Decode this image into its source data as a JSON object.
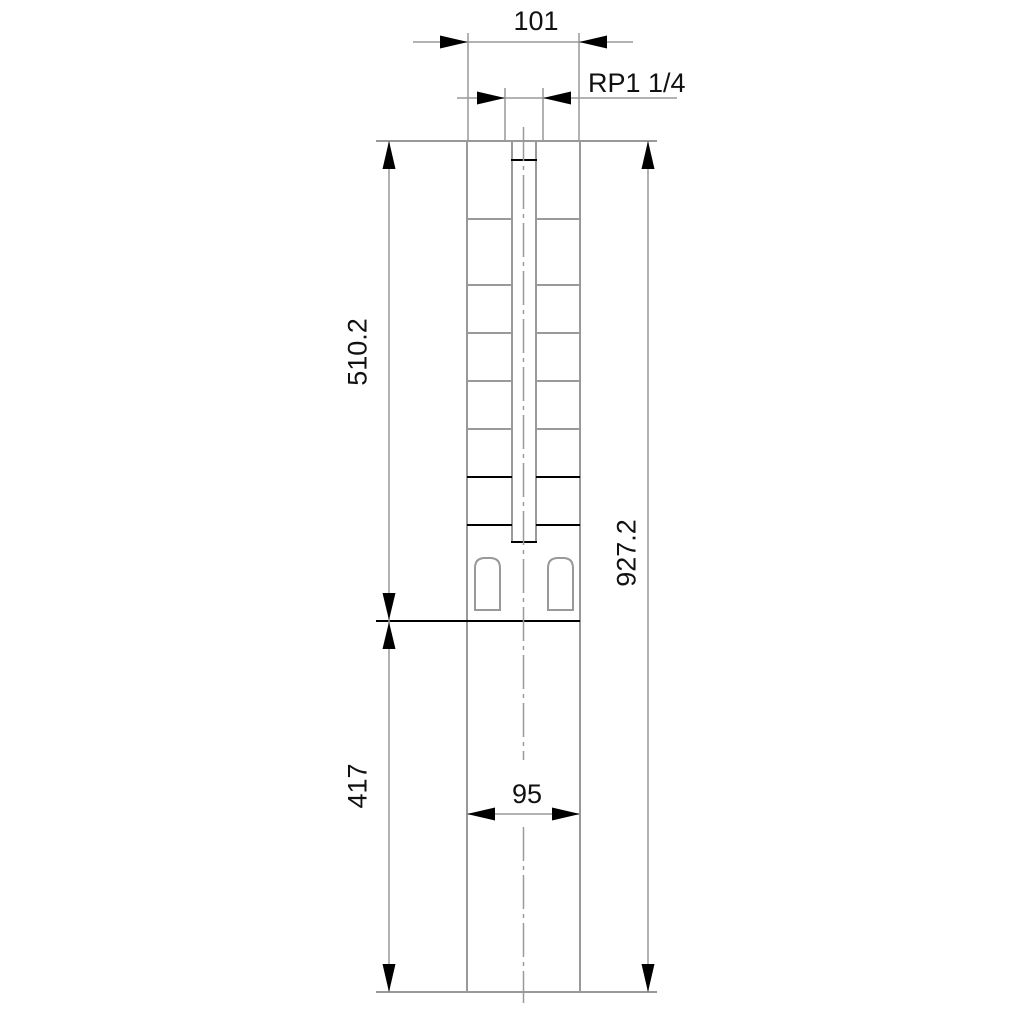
{
  "drawing": {
    "kind": "technical-outline-dimension-drawing",
    "subject": "submersible borehole pump with motor, front view",
    "labels": {
      "width_top": "101",
      "thread": "RP1 1/4",
      "length_pump": "510.2",
      "length_total": "927.2",
      "length_motor": "417",
      "width_motor": "95"
    },
    "colors": {
      "background": "#ffffff",
      "outline_gray": "#999999",
      "detail_black": "#000000",
      "text": "#111111"
    }
  }
}
